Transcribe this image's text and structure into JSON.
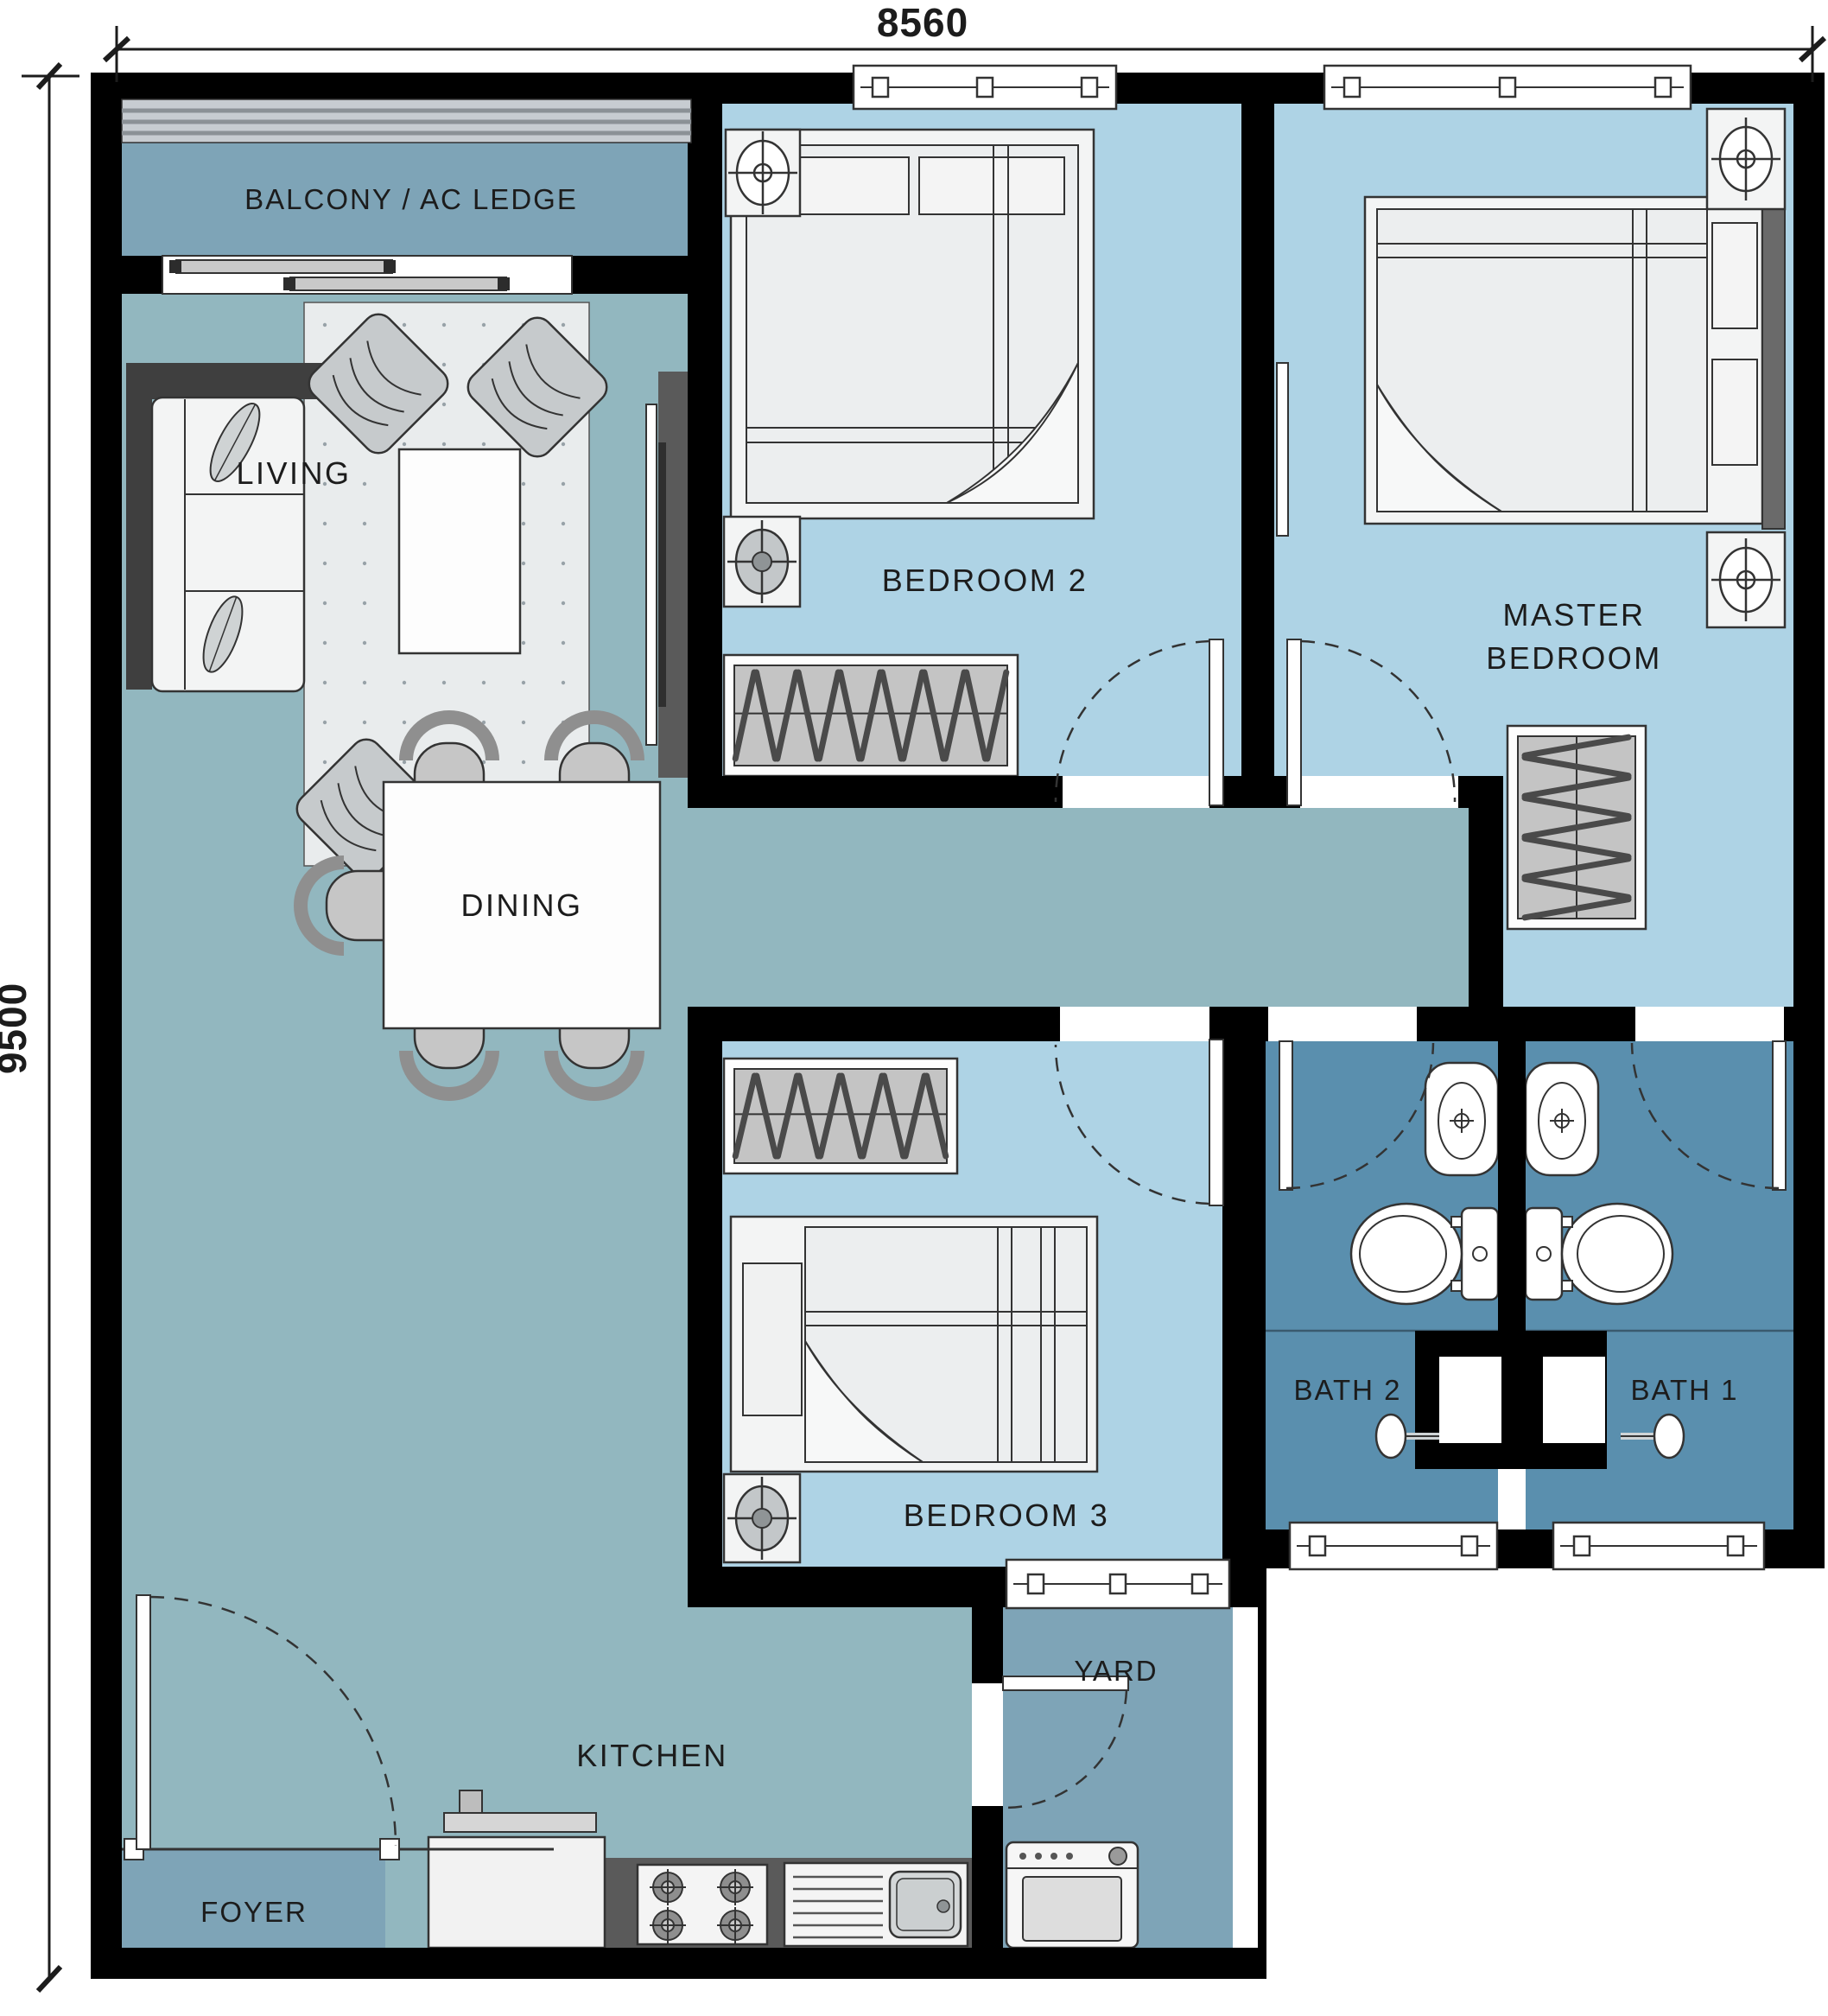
{
  "plan": {
    "type": "apartment-floor-plan",
    "dimensions": {
      "top": "8560",
      "left": "9500"
    },
    "rooms": {
      "balcony": "BALCONY / AC LEDGE",
      "living": "LIVING",
      "bedroom2": "BEDROOM 2",
      "master_line1": "MASTER",
      "master_line2": "BEDROOM",
      "dining": "DINING",
      "bedroom3": "BEDROOM 3",
      "bath2": "BATH 2",
      "bath1": "BATH 1",
      "yard": "YARD",
      "kitchen": "KITCHEN",
      "foyer": "FOYER"
    },
    "colors": {
      "open_area": "#92b7bf",
      "bedroom": "#aed3e5",
      "service": "#7ea4b7",
      "bath": "#5a8fae",
      "wall": "#000000",
      "rug": "#e9eced",
      "counter_dark": "#5a5a5a",
      "accent_dark": "#3f3f3f"
    }
  }
}
